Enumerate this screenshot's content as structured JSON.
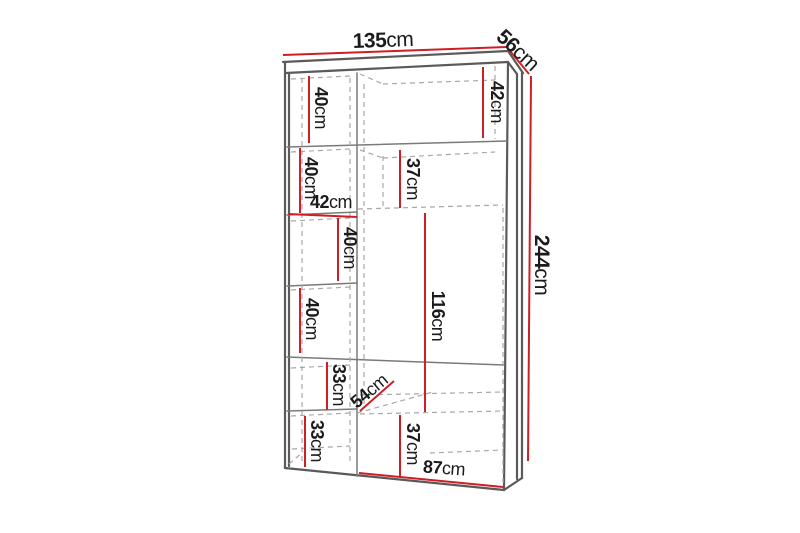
{
  "colors": {
    "dimension_red": "#cc1f26",
    "structure_dark": "#5a5a5a",
    "structure_gray": "#7a7a7a",
    "dashed_gray": "#a8a8a8",
    "text": "#1b1b1b",
    "background": "#ffffff"
  },
  "diagram": {
    "overall": {
      "width": {
        "value": "135",
        "unit": "cm"
      },
      "depth": {
        "value": "56",
        "unit": "cm"
      },
      "height": {
        "value": "244",
        "unit": "cm"
      }
    },
    "interior": {
      "top_left_shelf_height": {
        "value": "40",
        "unit": "cm"
      },
      "top_right_shelf_height": {
        "value": "42",
        "unit": "cm"
      },
      "row2_left_shelf_height": {
        "value": "40",
        "unit": "cm"
      },
      "row2_middle_shelf_height": {
        "value": "37",
        "unit": "cm"
      },
      "left_column_width": {
        "value": "42",
        "unit": "cm"
      },
      "row3_shelf_height": {
        "value": "40",
        "unit": "cm"
      },
      "row4_left_shelf_height": {
        "value": "40",
        "unit": "cm"
      },
      "hanging_section_height": {
        "value": "116",
        "unit": "cm"
      },
      "row5_left_shelf_height": {
        "value": "33",
        "unit": "cm"
      },
      "interior_depth": {
        "value": "54",
        "unit": "cm"
      },
      "bottom_left_shelf_height": {
        "value": "33",
        "unit": "cm"
      },
      "bottom_middle_shelf_height": {
        "value": "37",
        "unit": "cm"
      },
      "right_column_width": {
        "value": "87",
        "unit": "cm"
      }
    }
  }
}
